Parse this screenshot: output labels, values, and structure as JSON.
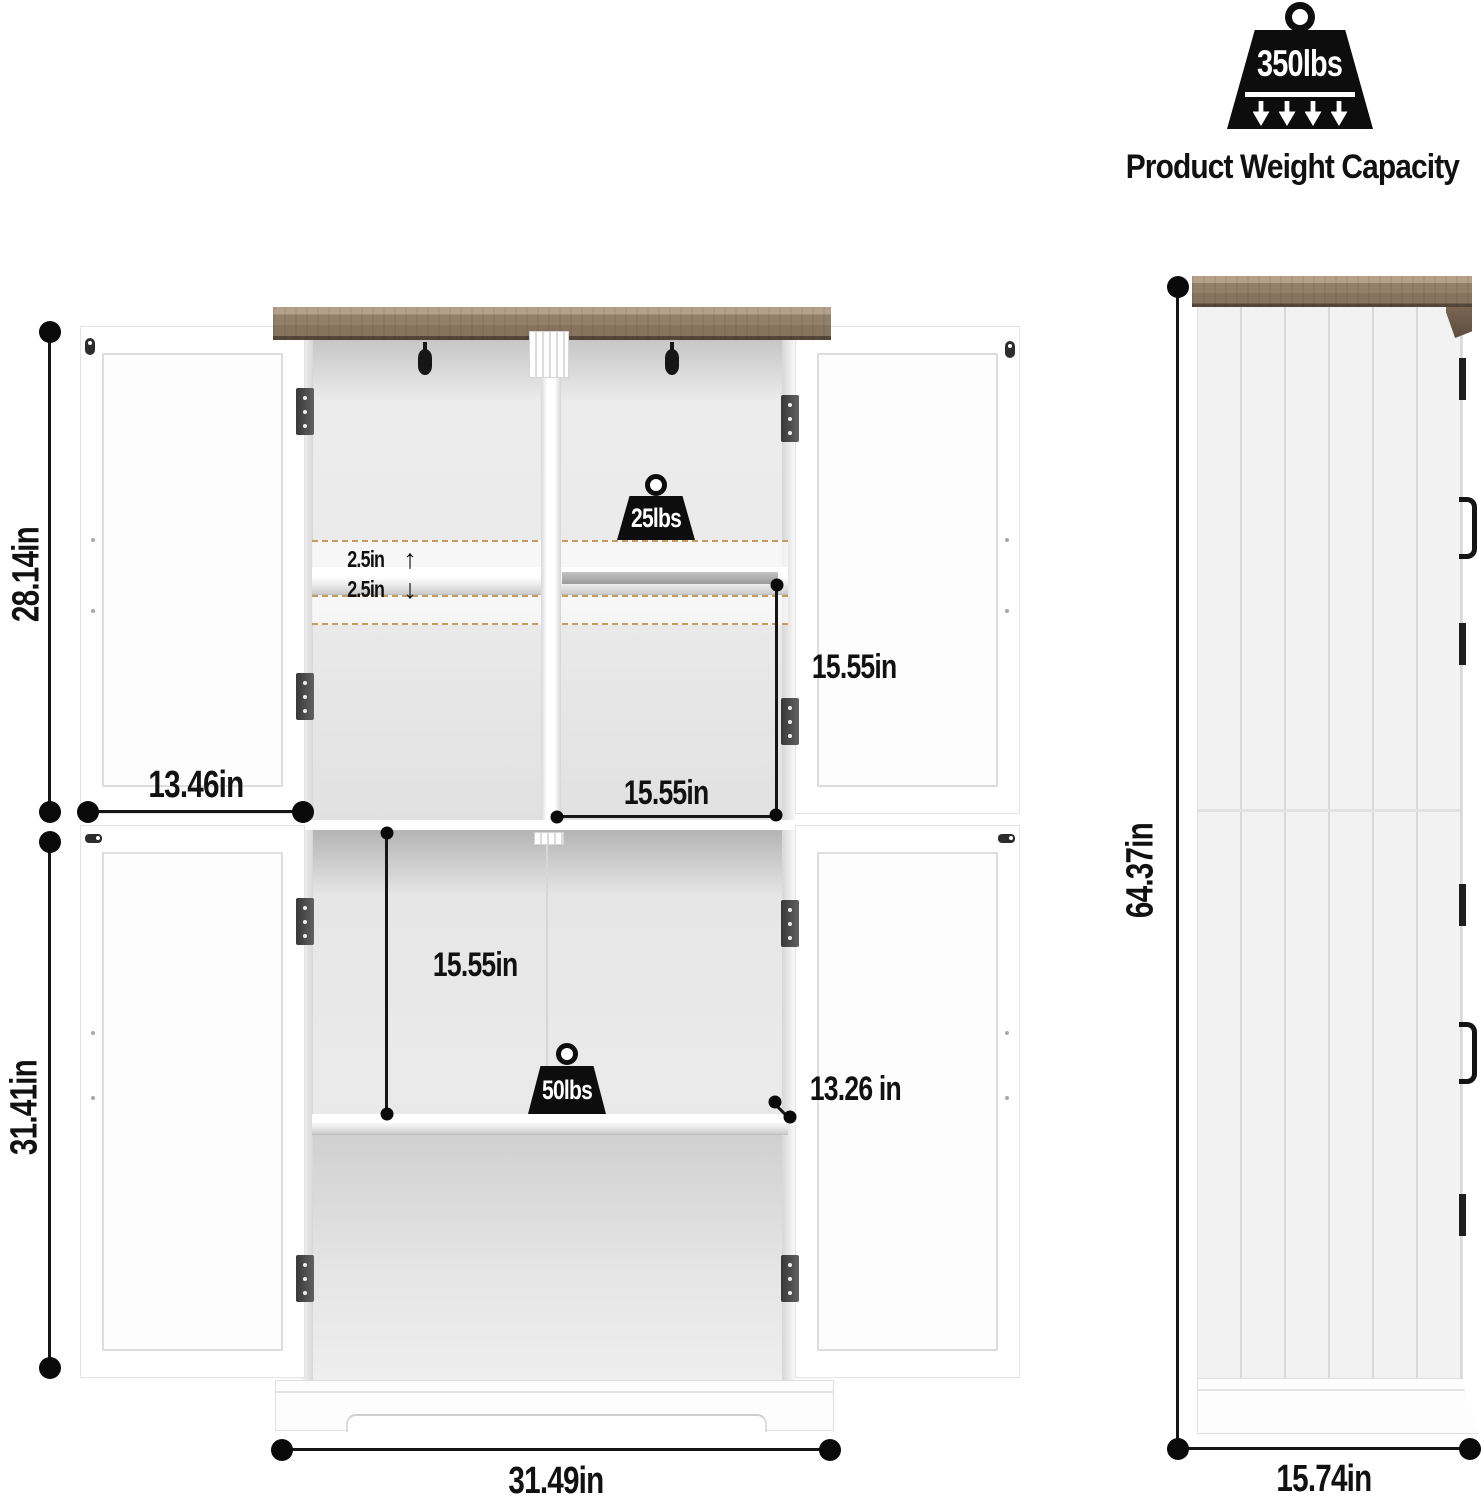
{
  "capacity_badge": {
    "weight_label": "350lbs",
    "caption": "Product Weight Capacity"
  },
  "front_view": {
    "upper_section_height": "28.14in",
    "door_width": "13.46in",
    "lower_section_height": "31.41in",
    "shelf_adjust_up": "2.5in",
    "shelf_adjust_down": "2.5in",
    "arrow_up": "↑",
    "arrow_down": "↓",
    "upper_compartment_height": "15.55in",
    "upper_compartment_width": "15.55in",
    "upper_shelf_capacity": "25lbs",
    "lower_compartment_height": "15.55in",
    "lower_shelf_capacity": "50lbs",
    "shelf_depth": "13.26 in",
    "overall_width": "31.49in"
  },
  "side_view": {
    "overall_height": "64.37in",
    "overall_depth": "15.74in"
  },
  "colors": {
    "wood_top": "#87745f",
    "dashed_shelf_outline": "#c89a5e",
    "hardware_black": "#1e1e1e",
    "hinge_gray": "#4a4a4a",
    "dimension_ink": "#111111"
  }
}
